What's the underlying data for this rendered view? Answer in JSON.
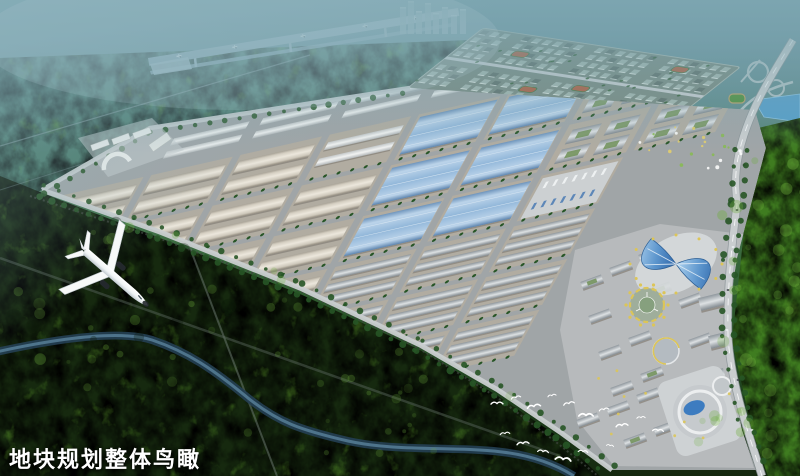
{
  "text": {
    "caption": "地块规划整体鸟瞰"
  },
  "colors": {
    "sky_haze": "#7aa4af",
    "haze_light": "#a9c6cf",
    "forest_distant": "#48796a",
    "forest_dark": "#16290f",
    "forest_mid": "#2f5c2f",
    "forest_bright": "#3f7c20",
    "forest_highlight": "#6fae3d",
    "runway": "#8fadbd",
    "runway_light": "#b5c9d4",
    "road": "#9fa6ab",
    "road_light": "#c9cdcf",
    "park_ground": "#a0a5a7",
    "block_ground": "#b4ada0",
    "wall_dark": "#8a857c",
    "roof_beige": "#e3dfd6",
    "roof_blue": "#8fb4d8",
    "roof_white": "#eceded",
    "residential_ground": "#78897f",
    "residential_building": "#a3b5ad",
    "residential_dark": "#5d6d66",
    "sports_field": "#b05a3a",
    "water": "#2c4f66",
    "water_light": "#5d87a0",
    "lake_blue": "#55a0cf",
    "tree": "#275526",
    "landmark_blue": "#3d7cc0",
    "landmark_blue_light": "#9cc6e8",
    "accent_yellow": "#dcc558",
    "commercial_wall": "#b0b7bd",
    "plane_white": "#f7f9f8",
    "plane_shadow": "#bcc5cb",
    "plane_dark": "#23282c",
    "bird_white": "#ffffff",
    "caption": "#ffffff"
  },
  "scene": {
    "type": "aerial-masterplan-rendering",
    "elements": [
      "airport-runway",
      "distant-city-skyline",
      "highway-interchange",
      "lake",
      "residential-district",
      "canal",
      "garden-strip",
      "industrial-district",
      "commercial-district",
      "landmark-butterfly-building",
      "circular-plaza",
      "mall-complex",
      "highway",
      "river",
      "forest",
      "airplane",
      "egret-flock",
      "caption"
    ]
  }
}
